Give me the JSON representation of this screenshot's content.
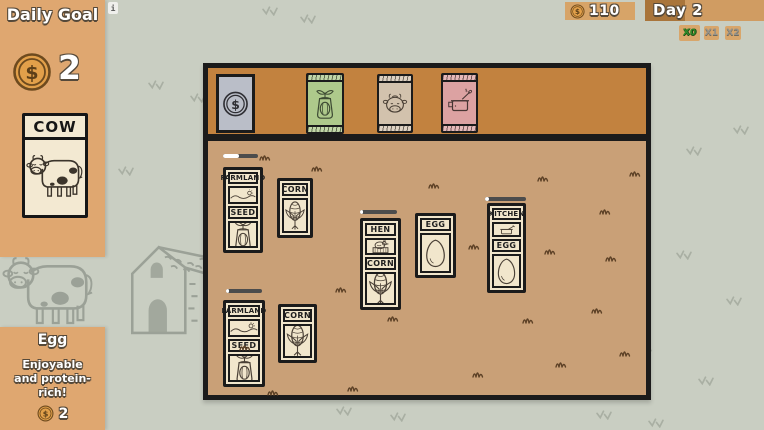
{
  "hud": {
    "daily_goal_title": "Daily Goal",
    "daily_goal_amount": "2",
    "goal_card_label": "COW",
    "money_amount": "110",
    "day_label": "Day 2",
    "info_badge": "i",
    "speed": {
      "x0": "X0",
      "x1": "X1",
      "x2": "X2"
    }
  },
  "info_panel": {
    "item_name": "Egg",
    "item_description": "Enjoyable and protein-rich!",
    "item_price": "2"
  },
  "board": {
    "labels": {
      "farmland": "FARMLAND",
      "seed": "SEED",
      "corn": "CORN",
      "hen": "HEN",
      "egg": "EGG",
      "kitchen": "KITCHEN"
    },
    "progress": {
      "farm1_style": "width:46%",
      "hen_style": "width:7%",
      "kitchen_style": "width:10%",
      "farm2_style": "width:7%"
    }
  },
  "shop": {
    "slots": [
      "money-card",
      "seed-packet-green",
      "cow-packet",
      "kitchen-packet-pink"
    ]
  },
  "icons": {
    "coin_symbol": "$",
    "coin": "dollar-coin",
    "money_card": "dollar-card",
    "seed_packet": "sprout-pouch",
    "cow_packet": "cow-face",
    "kitchen_packet": "cooking-pot",
    "corn": "corn-cob",
    "egg": "egg",
    "hen": "hen-in-nest",
    "farmland": "hills-landscape",
    "kitchen": "pan-utensil"
  },
  "colors": {
    "background": "#c9cec2",
    "panel_tan": "#dfa770",
    "board_tan": "#c9a077",
    "shop_bar_orange": "#c2823f",
    "card_cream": "#f1e6cc",
    "coin_gold": "#e2a04a",
    "speed_active_green": "#2f8b2a",
    "outline_dark": "#1b1b1b"
  }
}
